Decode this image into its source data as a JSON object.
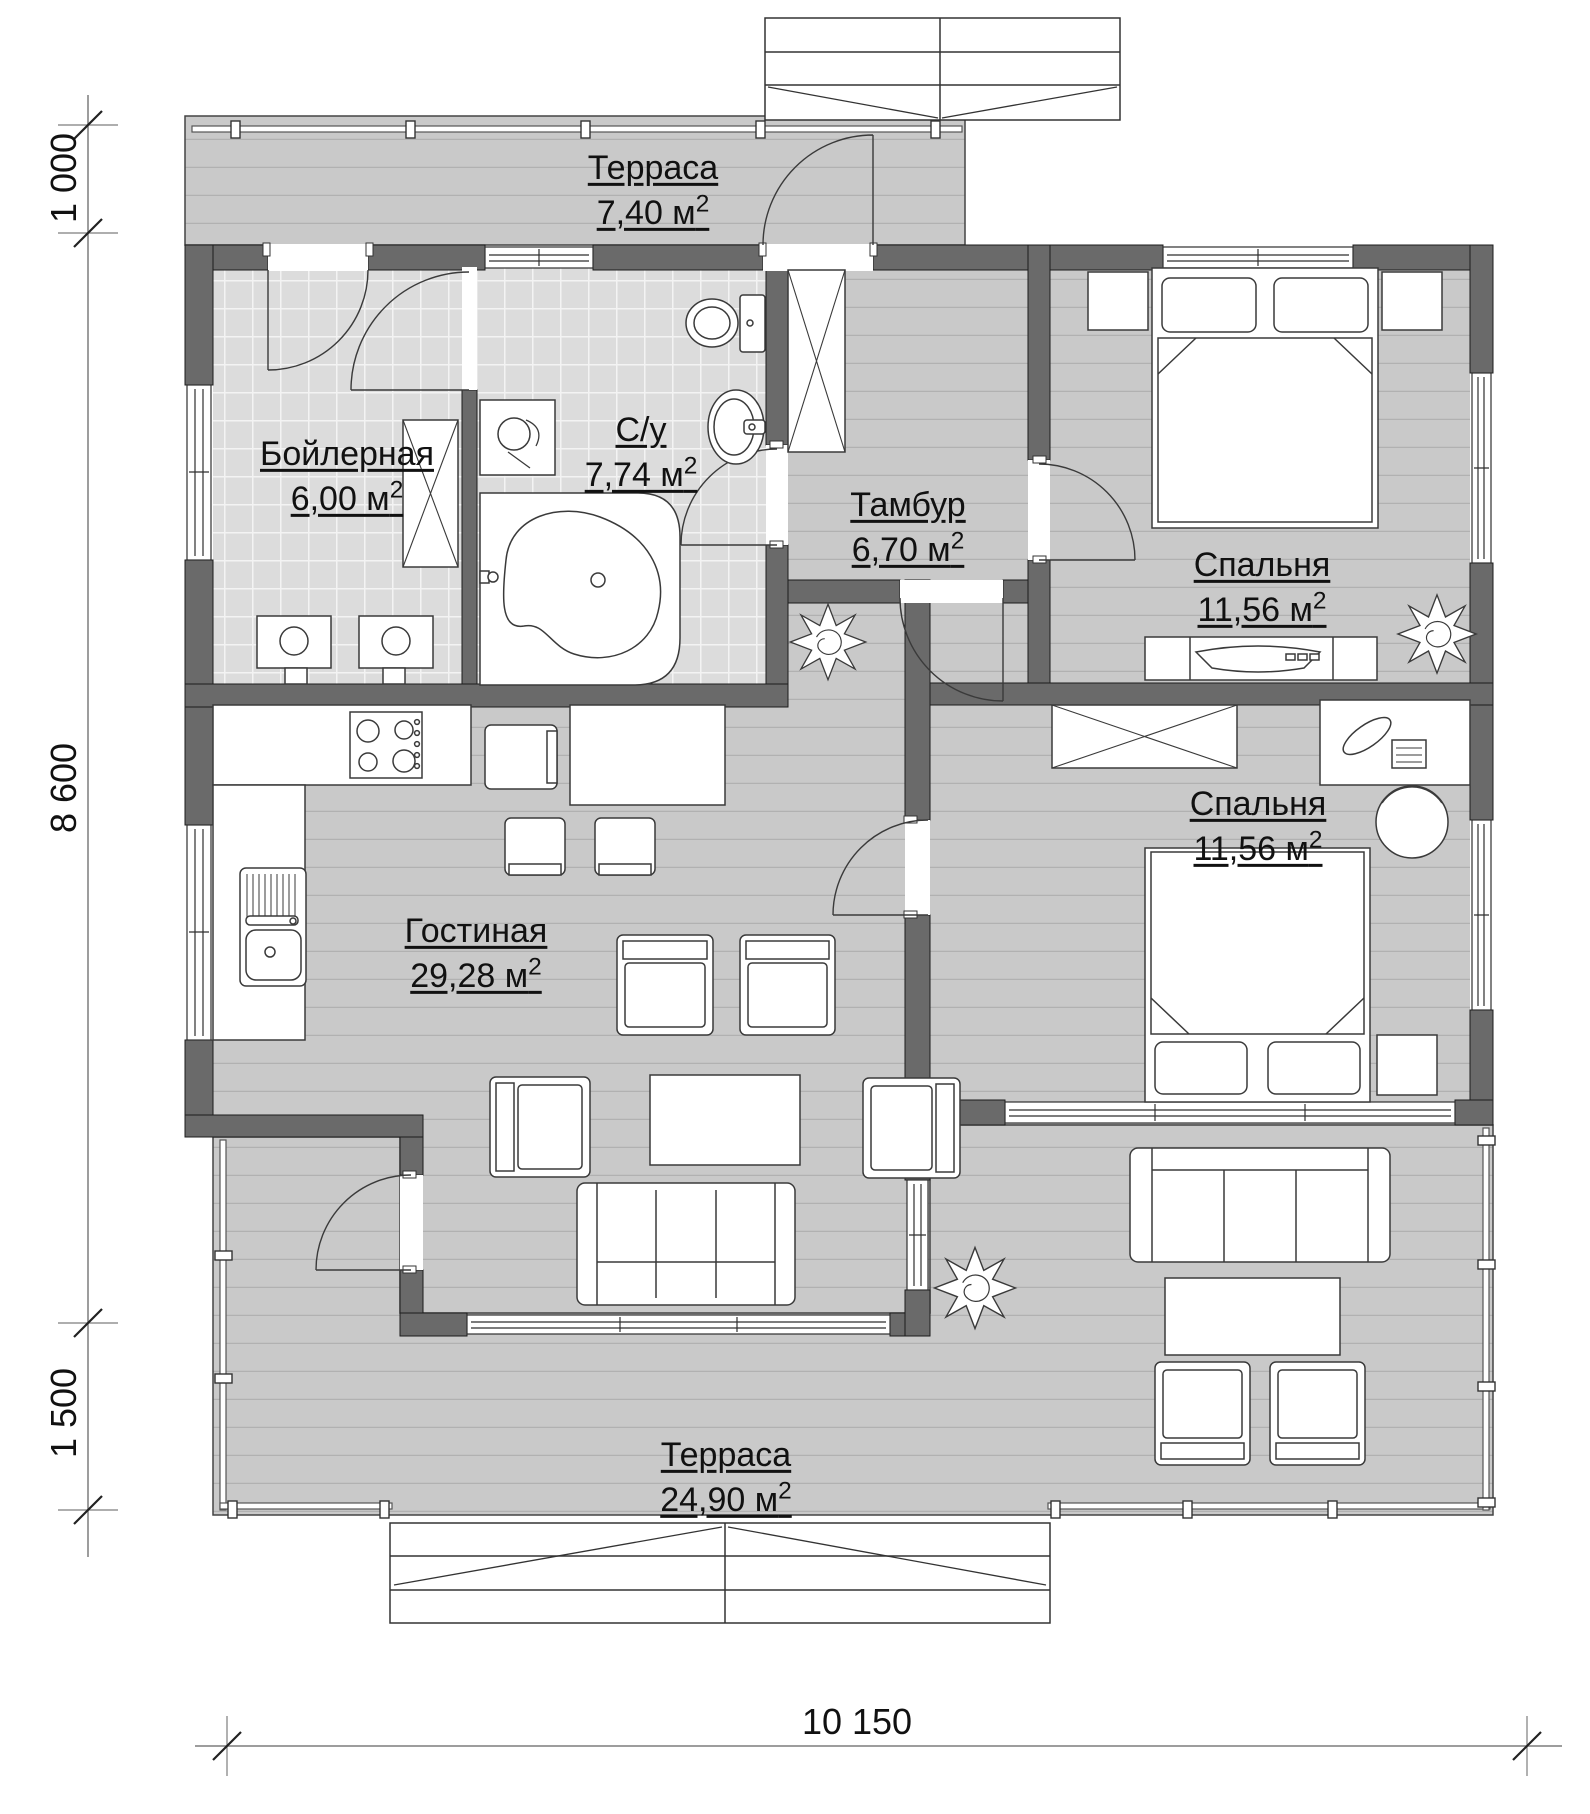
{
  "rooms": [
    {
      "id": "terrace-top",
      "name": "Терраса",
      "area": "7,40 м",
      "sup": "2"
    },
    {
      "id": "boiler",
      "name": "Бойлерная",
      "area": "6,00 м",
      "sup": "2"
    },
    {
      "id": "bathroom",
      "name": "С/у",
      "area": "7,74 м",
      "sup": "2"
    },
    {
      "id": "vestibule",
      "name": "Тамбур",
      "area": "6,70 м",
      "sup": "2"
    },
    {
      "id": "bedroom-1",
      "name": "Спальня",
      "area": "11,56 м",
      "sup": "2"
    },
    {
      "id": "bedroom-2",
      "name": "Спальня",
      "area": "11,56 м",
      "sup": "2"
    },
    {
      "id": "living-room",
      "name": "Гостиная",
      "area": "29,28 м",
      "sup": "2"
    },
    {
      "id": "terrace-bottom",
      "name": "Терраса",
      "area": "24,90 м",
      "sup": "2"
    }
  ],
  "dimensions": {
    "top_left": "1 000",
    "left": "8 600",
    "bottom_left": "1 500",
    "bottom": "10 150"
  },
  "colors": {
    "wall": "#6a6a6a",
    "floor_plank": "#c9c9c9",
    "floor_tile": "#dcdcdc",
    "outline": "#2e2e2e",
    "background": "#ffffff"
  }
}
